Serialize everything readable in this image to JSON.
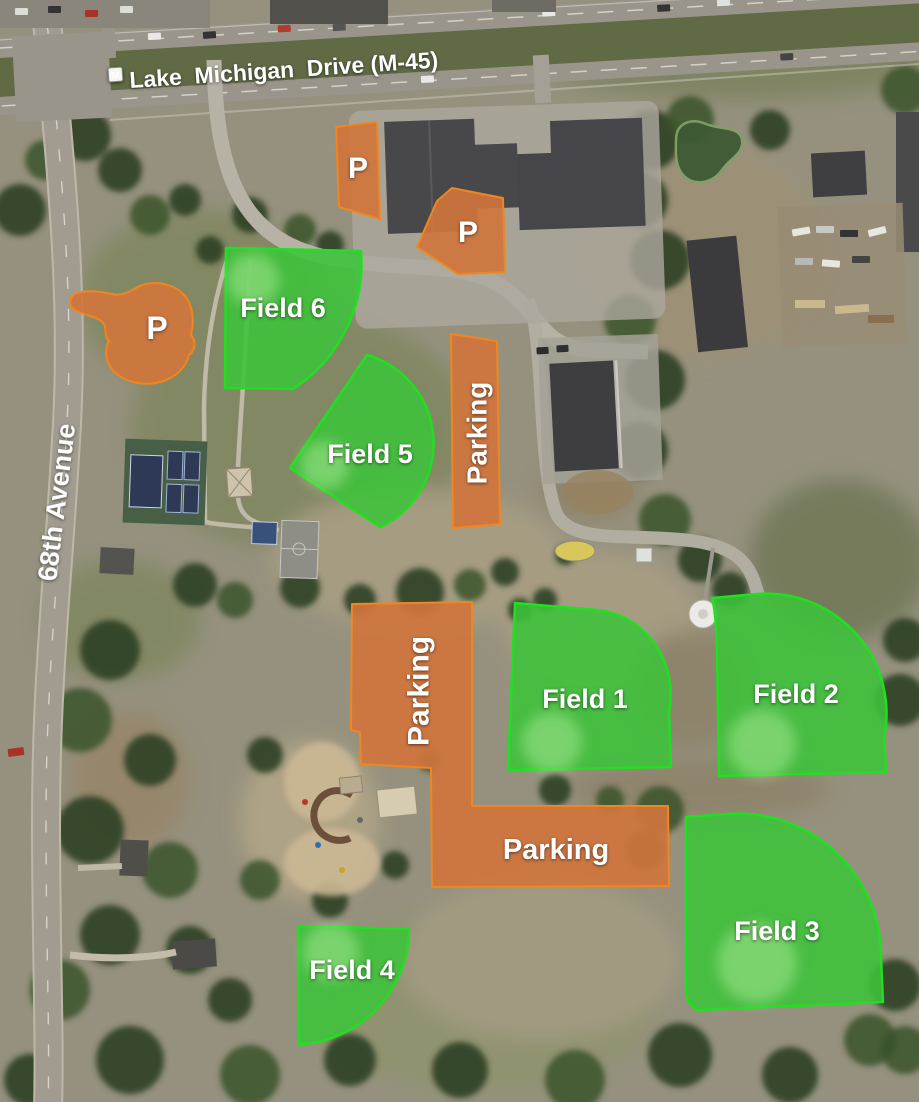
{
  "streets": {
    "main": {
      "label": "Lake  Michigan  Drive (M-45)",
      "shield": "M"
    },
    "cross": {
      "label": "68th Avenue"
    }
  },
  "fields": [
    {
      "label": "Field 1"
    },
    {
      "label": "Field 2"
    },
    {
      "label": "Field 3"
    },
    {
      "label": "Field 4"
    },
    {
      "label": "Field 5"
    },
    {
      "label": "Field 6"
    }
  ],
  "parking": {
    "p_markers": [
      {
        "label": "P"
      },
      {
        "label": "P"
      },
      {
        "label": "P"
      }
    ],
    "lots": [
      {
        "label": "Parking"
      },
      {
        "label": "Parking"
      },
      {
        "label": "Parking"
      }
    ]
  },
  "colors": {
    "field_fill": "#3cc33a",
    "field_border": "#21df21",
    "parking_fill": "#d0753d",
    "parking_border": "#ef861f",
    "label_text": "#ffffff"
  }
}
